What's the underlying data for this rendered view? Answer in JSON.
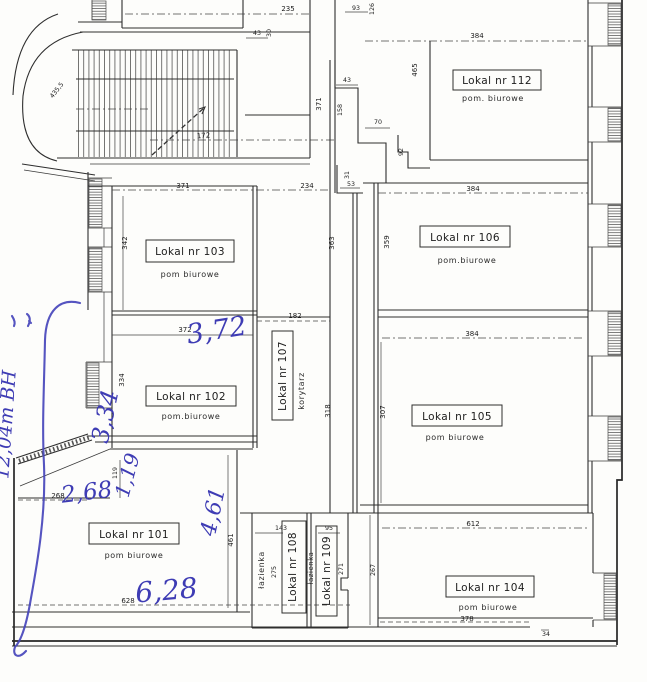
{
  "document": {
    "kind": "scanned architectural floor plan with handwritten measurements"
  },
  "rooms": {
    "r101": {
      "label": "Lokal nr 101",
      "sub": "pom biurowe"
    },
    "r102": {
      "label": "Lokal nr 102",
      "sub": "pom.biurowe"
    },
    "r103": {
      "label": "Lokal nr 103",
      "sub": "pom biurowe"
    },
    "r104": {
      "label": "Lokal nr 104",
      "sub": "pom biurowe"
    },
    "r105": {
      "label": "Lokal nr 105",
      "sub": "pom biurowe"
    },
    "r106": {
      "label": "Lokal nr 106",
      "sub": "pom.biurowe"
    },
    "r107": {
      "label": "Lokal nr 107",
      "sub": "korytarz"
    },
    "r108": {
      "label": "Lokal nr 108",
      "sub": "łazienka"
    },
    "r109": {
      "label": "Lokal nr 109",
      "sub": "łazienka"
    },
    "r112": {
      "label": "Lokal nr 112",
      "sub": "pom. biurowe"
    }
  },
  "dims": {
    "d235": "235",
    "d43_top": "43",
    "d30": "30",
    "d93": "93",
    "d126": "126",
    "d43_mid": "43",
    "d158": "158",
    "d70": "70",
    "d92": "92",
    "d465": "465",
    "d384_112": "384",
    "d371_v": "371",
    "d371_103": "371",
    "d234": "234",
    "d342": "342",
    "d363": "363",
    "d359": "359",
    "d182": "182",
    "d372": "372",
    "d334": "334",
    "d318": "318",
    "d384_106": "384",
    "d384_105": "384",
    "d307": "307",
    "d268": "268",
    "d119": "119",
    "d461": "461",
    "d628": "628",
    "d143": "143",
    "d275": "275",
    "d95": "95",
    "d271": "271",
    "d267": "267",
    "d612": "612",
    "d378": "378",
    "d34": "34",
    "d53": "53",
    "d31": "31",
    "d172": "172",
    "d435": "435,5"
  },
  "annotations": {
    "ink_color": "#3e3cb4",
    "w372": "3,72",
    "w334": "3,34",
    "w119": "1,19",
    "w268": "2,68",
    "w461": "4,61",
    "w628": "6,28",
    "side_note": "12,04m BH"
  }
}
